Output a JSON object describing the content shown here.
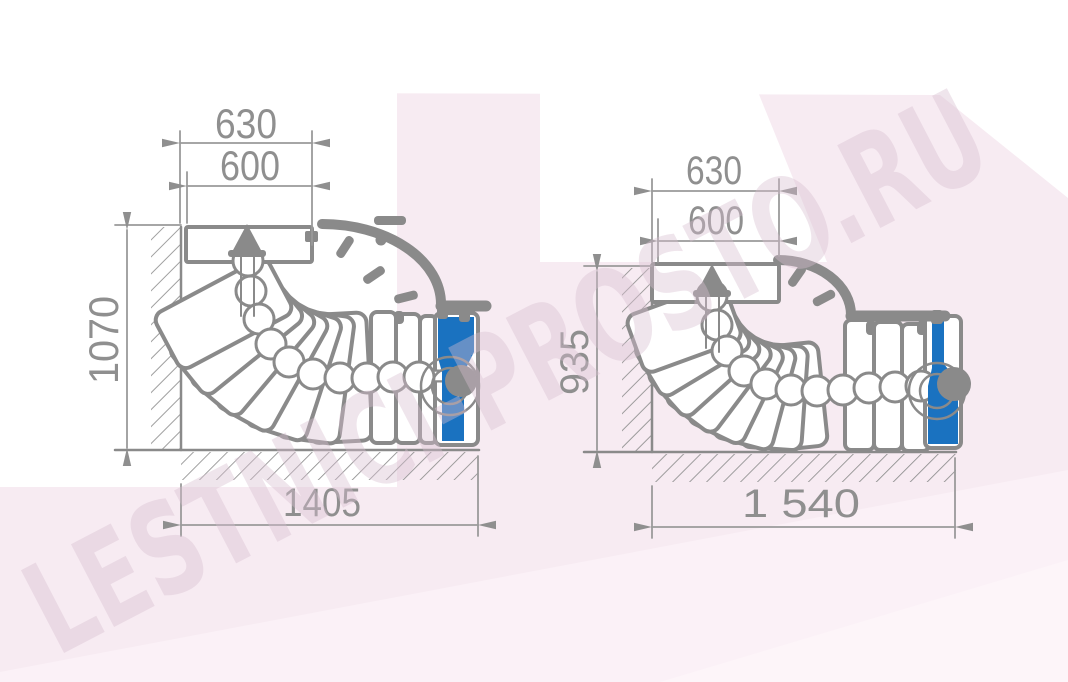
{
  "watermark": {
    "text": "LESTNICI-PROSTO.RU"
  },
  "colors": {
    "line_gray": "#8a8a8a",
    "dimension_gray": "#8f8f8f",
    "post_blue": "#1a72c0",
    "background_pink": "#f7ebf2",
    "background_white": "#ffffff",
    "watermark_tint": "#d8bfd0"
  },
  "left_drawing": {
    "dimensions": {
      "top_outer": "630",
      "top_inner": "600",
      "height": "1070",
      "length": "1405"
    }
  },
  "right_drawing": {
    "dimensions": {
      "top_outer": "630",
      "top_inner": "600",
      "height": "935",
      "length": "1 540"
    }
  }
}
